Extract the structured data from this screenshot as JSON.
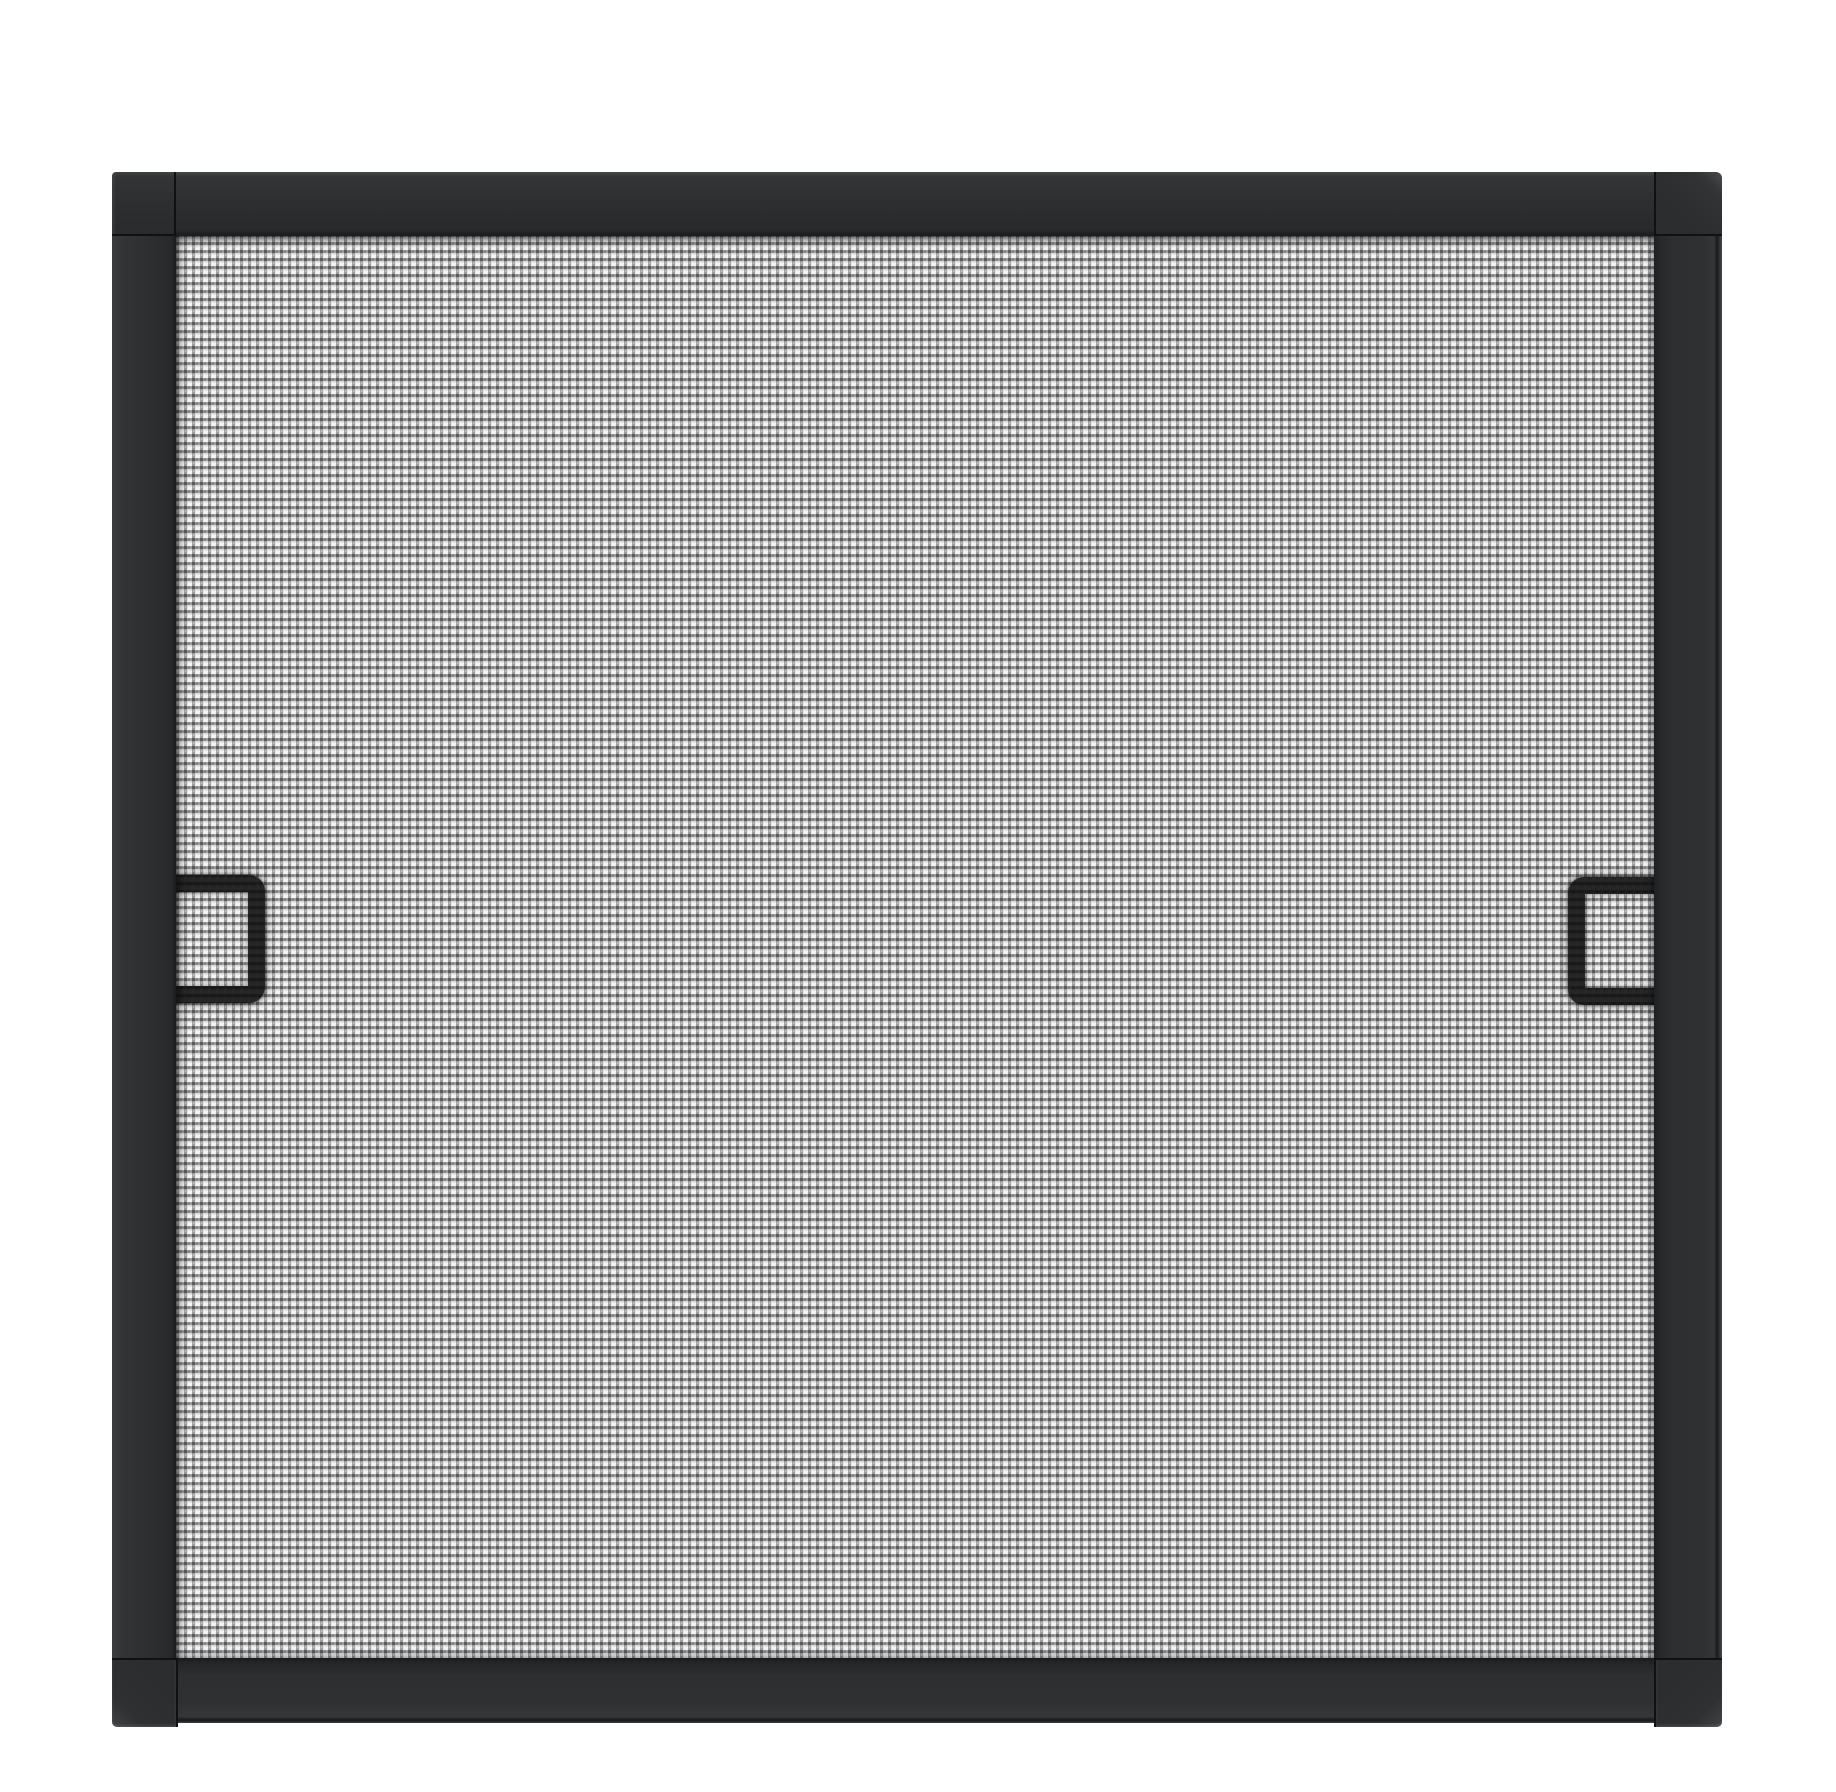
{
  "scene": {
    "description": "Black-framed window insect screen with gray woven mesh and two pull tabs",
    "parts": {
      "frame": "screen frame",
      "mesh": "woven screen mesh",
      "left_handle": "left pull tab",
      "right_handle": "right pull tab"
    }
  },
  "colors": {
    "page-bg": "#ffffff",
    "frame-body": "#2d2f31",
    "frame-light": "#45474a",
    "frame-dark": "#1b1c1e",
    "frame-seam": "#101112",
    "mesh-white": "#fbfbfb",
    "mesh-yarn-h": "#a2a2a2",
    "mesh-yarn-v": "#999999",
    "mesh-knot": "#525252",
    "mesh-cell-shade": "#e0e0e0",
    "handle-black": "#0a0a0b"
  }
}
